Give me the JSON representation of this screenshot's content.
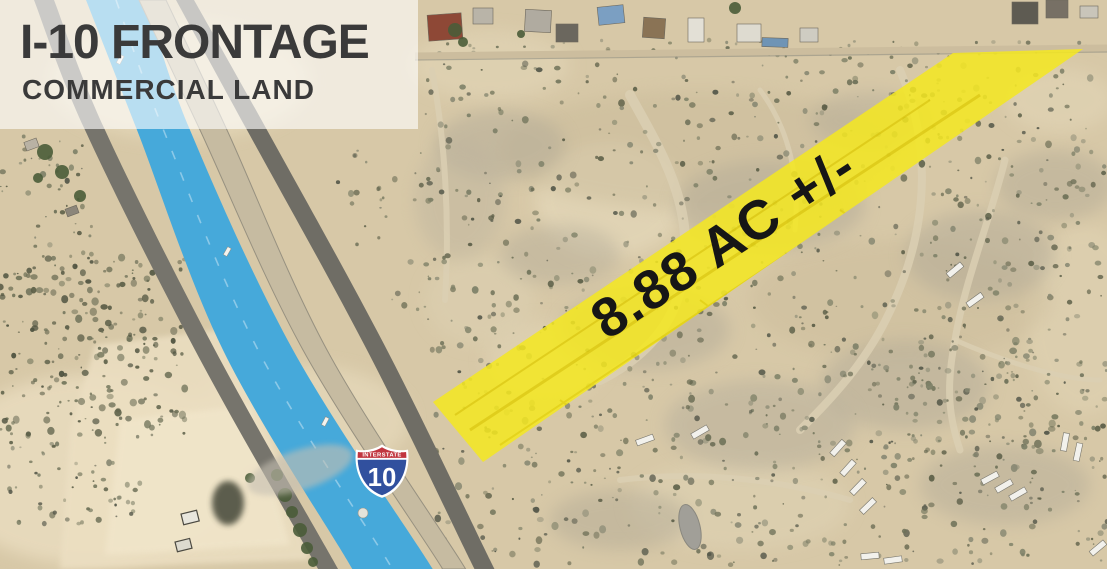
{
  "overlay": {
    "title": "I-10 FRONTAGE",
    "subtitle": "COMMERCIAL LAND"
  },
  "parcel": {
    "area_label": "8.88 AC +/-",
    "fill": "#f4e722"
  },
  "shield": {
    "top_label": "INTERSTATE",
    "route_number": "10",
    "red": "#c1353f",
    "blue": "#31509e"
  },
  "palette": {
    "sand": "#d7c8a7",
    "highway_blue": "#46a9da",
    "asphalt": "#76746c",
    "frontage_road": "#c6bba1"
  }
}
